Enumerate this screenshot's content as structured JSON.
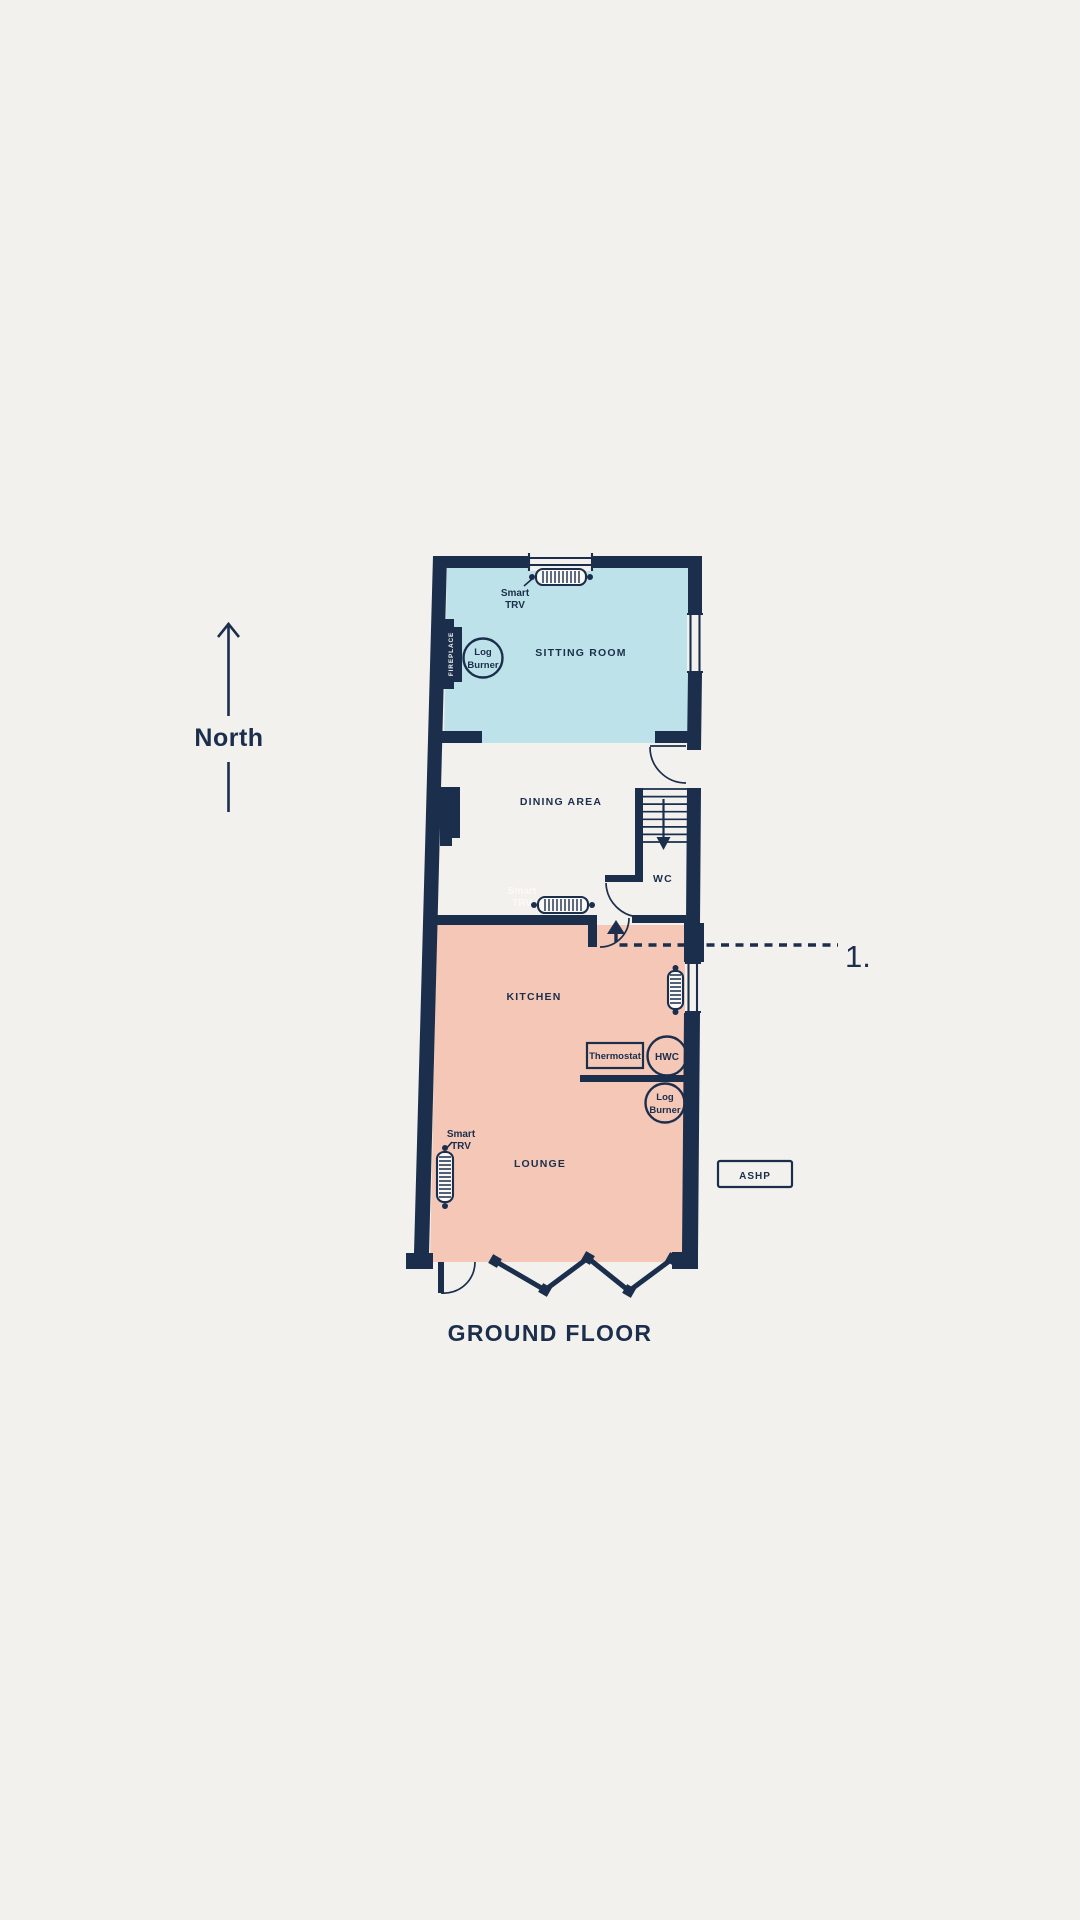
{
  "title": {
    "label": "GROUND FLOOR"
  },
  "compass": {
    "label": "North"
  },
  "callout": {
    "number_1": "1."
  },
  "rooms": {
    "sitting_room": "SITTING ROOM",
    "dining_area": "DINING AREA",
    "wc": "WC",
    "kitchen": "KITCHEN",
    "lounge": "LOUNGE"
  },
  "equipment": {
    "fireplace": "FIREPLACE",
    "log_burner_line1": "Log",
    "log_burner_line2": "Burner",
    "smart_trv_line1": "Smart",
    "smart_trv_line2": "TRV",
    "thermostat": "Thermostat",
    "hwc": "HWC",
    "ashp": "ASHP"
  },
  "colors": {
    "wall_navy": "#1b2e4c",
    "sitting_room_fill": "#bee2e9",
    "kitchen_lounge_fill": "#f4c7b6",
    "background": "#f3f1ee"
  }
}
